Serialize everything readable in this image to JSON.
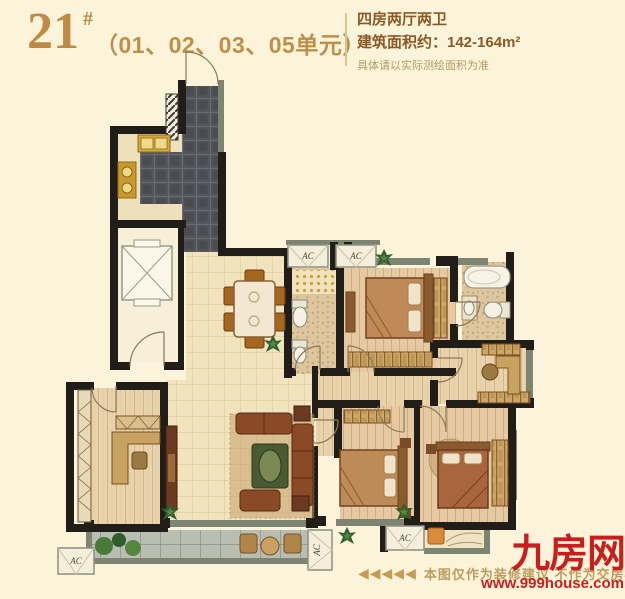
{
  "page": {
    "background": "#FBF4DB"
  },
  "colors": {
    "accent_gold": "#BE8C45",
    "text_brown": "#8A5A26",
    "note_tan": "#B49A60",
    "brand_red": "#C91E1E",
    "wall_black": "#211E1A",
    "window_gray": "#7D8471"
  },
  "header": {
    "block_number": "21",
    "hash": "#",
    "units": "（01、02、03、05单元）",
    "layout_type": "四房两厅两卫",
    "area_line": "建筑面积约：142-164m²",
    "area_note": "具体请以实际测绘面积为准"
  },
  "plan": {
    "ac_label": "AC"
  },
  "footer": {
    "arrows": "◀◀◀◀◀",
    "disclaimer": "本图仅作为装修建议 不作为交房标准"
  },
  "brand": {
    "logo": "九房网",
    "site": "www.999house.com"
  }
}
